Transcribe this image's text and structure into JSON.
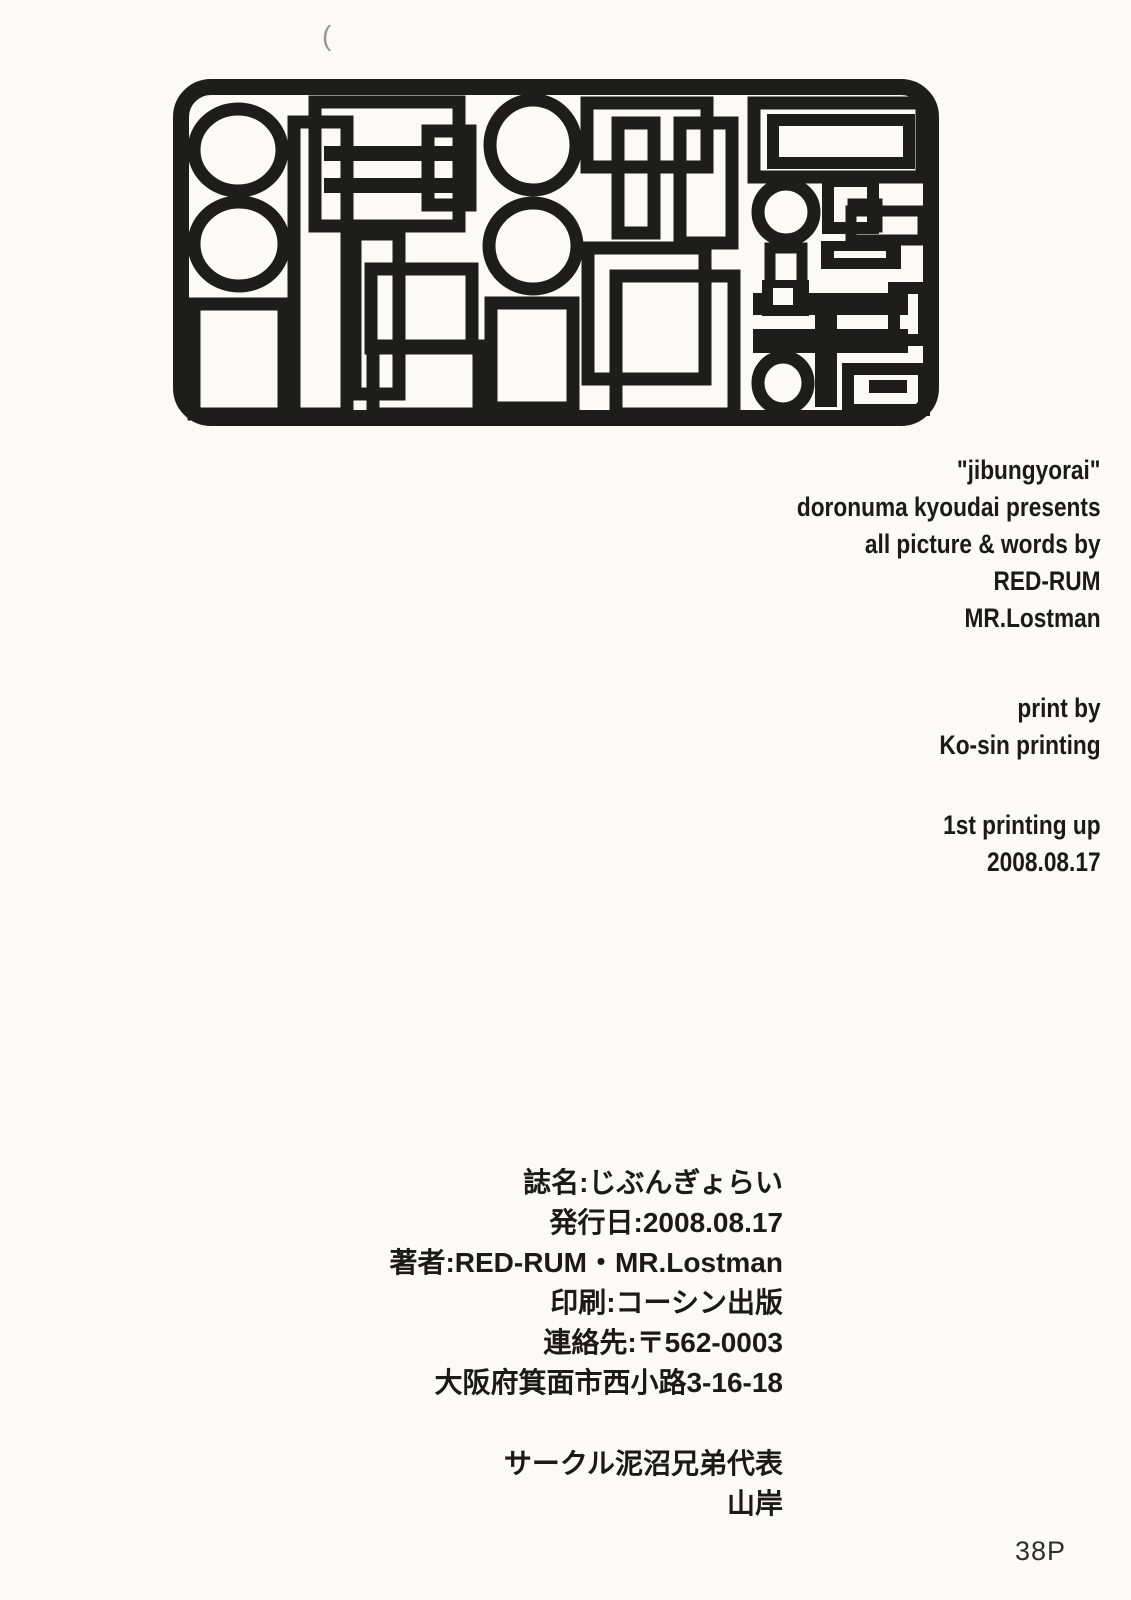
{
  "page": {
    "paper_color": "#fbfaf7",
    "ink_color": "#1d1d1b",
    "page_number": "38P",
    "scan_mark": "("
  },
  "logo": {
    "label": "doronuma kyoudai abstract geometric logo"
  },
  "english_credits": {
    "title_group": [
      "\"jibungyorai\"",
      "doronuma kyoudai presents",
      "all picture & words by",
      "RED-RUM",
      "MR.Lostman"
    ],
    "print_group": [
      "print by",
      "Ko-sin printing"
    ],
    "edition_group": [
      "1st printing up",
      "2008.08.17"
    ]
  },
  "japanese_colophon": {
    "info_lines": [
      "誌名:じぶんぎょらい",
      "発行日:2008.08.17",
      "著者:RED-RUM・MR.Lostman",
      "印刷:コーシン出版",
      "連絡先:〒562-0003",
      "大阪府箕面市西小路3-16-18"
    ],
    "circle_lines": [
      "サークル泥沼兄弟代表",
      "山岸"
    ]
  }
}
